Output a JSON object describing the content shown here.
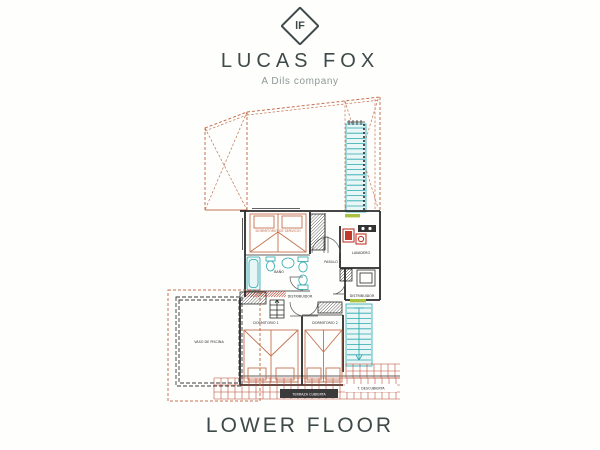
{
  "brand": {
    "monogram": "lF",
    "name": "LUCAS FOX",
    "tagline": "A Dils company"
  },
  "caption": "LOWER FLOOR",
  "plan": {
    "labels": {
      "service_bedroom": "DORMITORIO DE SERVICIO",
      "laundry": "LAVADERO",
      "bathroom": "BAÑO",
      "hallway": "PASILLO",
      "distributor_center": "DISTRIBUIDOR",
      "distributor_right": "DISTRIBUIDOR",
      "bedroom_1": "DORMITORIO 1",
      "bedroom_2": "DORMITORIO 2",
      "pool": "VASO DE PISCINA",
      "covered_terrace": "TERRAZA CUBIERTA",
      "uncovered_terrace": "T. DESCUBIERTA"
    },
    "colors": {
      "outline_orange": "#c4704f",
      "wall_dark": "#2b2b2b",
      "fixture_teal": "#27a7ae",
      "fixture_fill": "#e8f6f6",
      "appliance_red": "#c0392b",
      "tile_red": "#b8432e",
      "level_green": "#a9c23f",
      "brand_dark": "#3e4a49",
      "brand_gray": "#8e9897"
    }
  }
}
